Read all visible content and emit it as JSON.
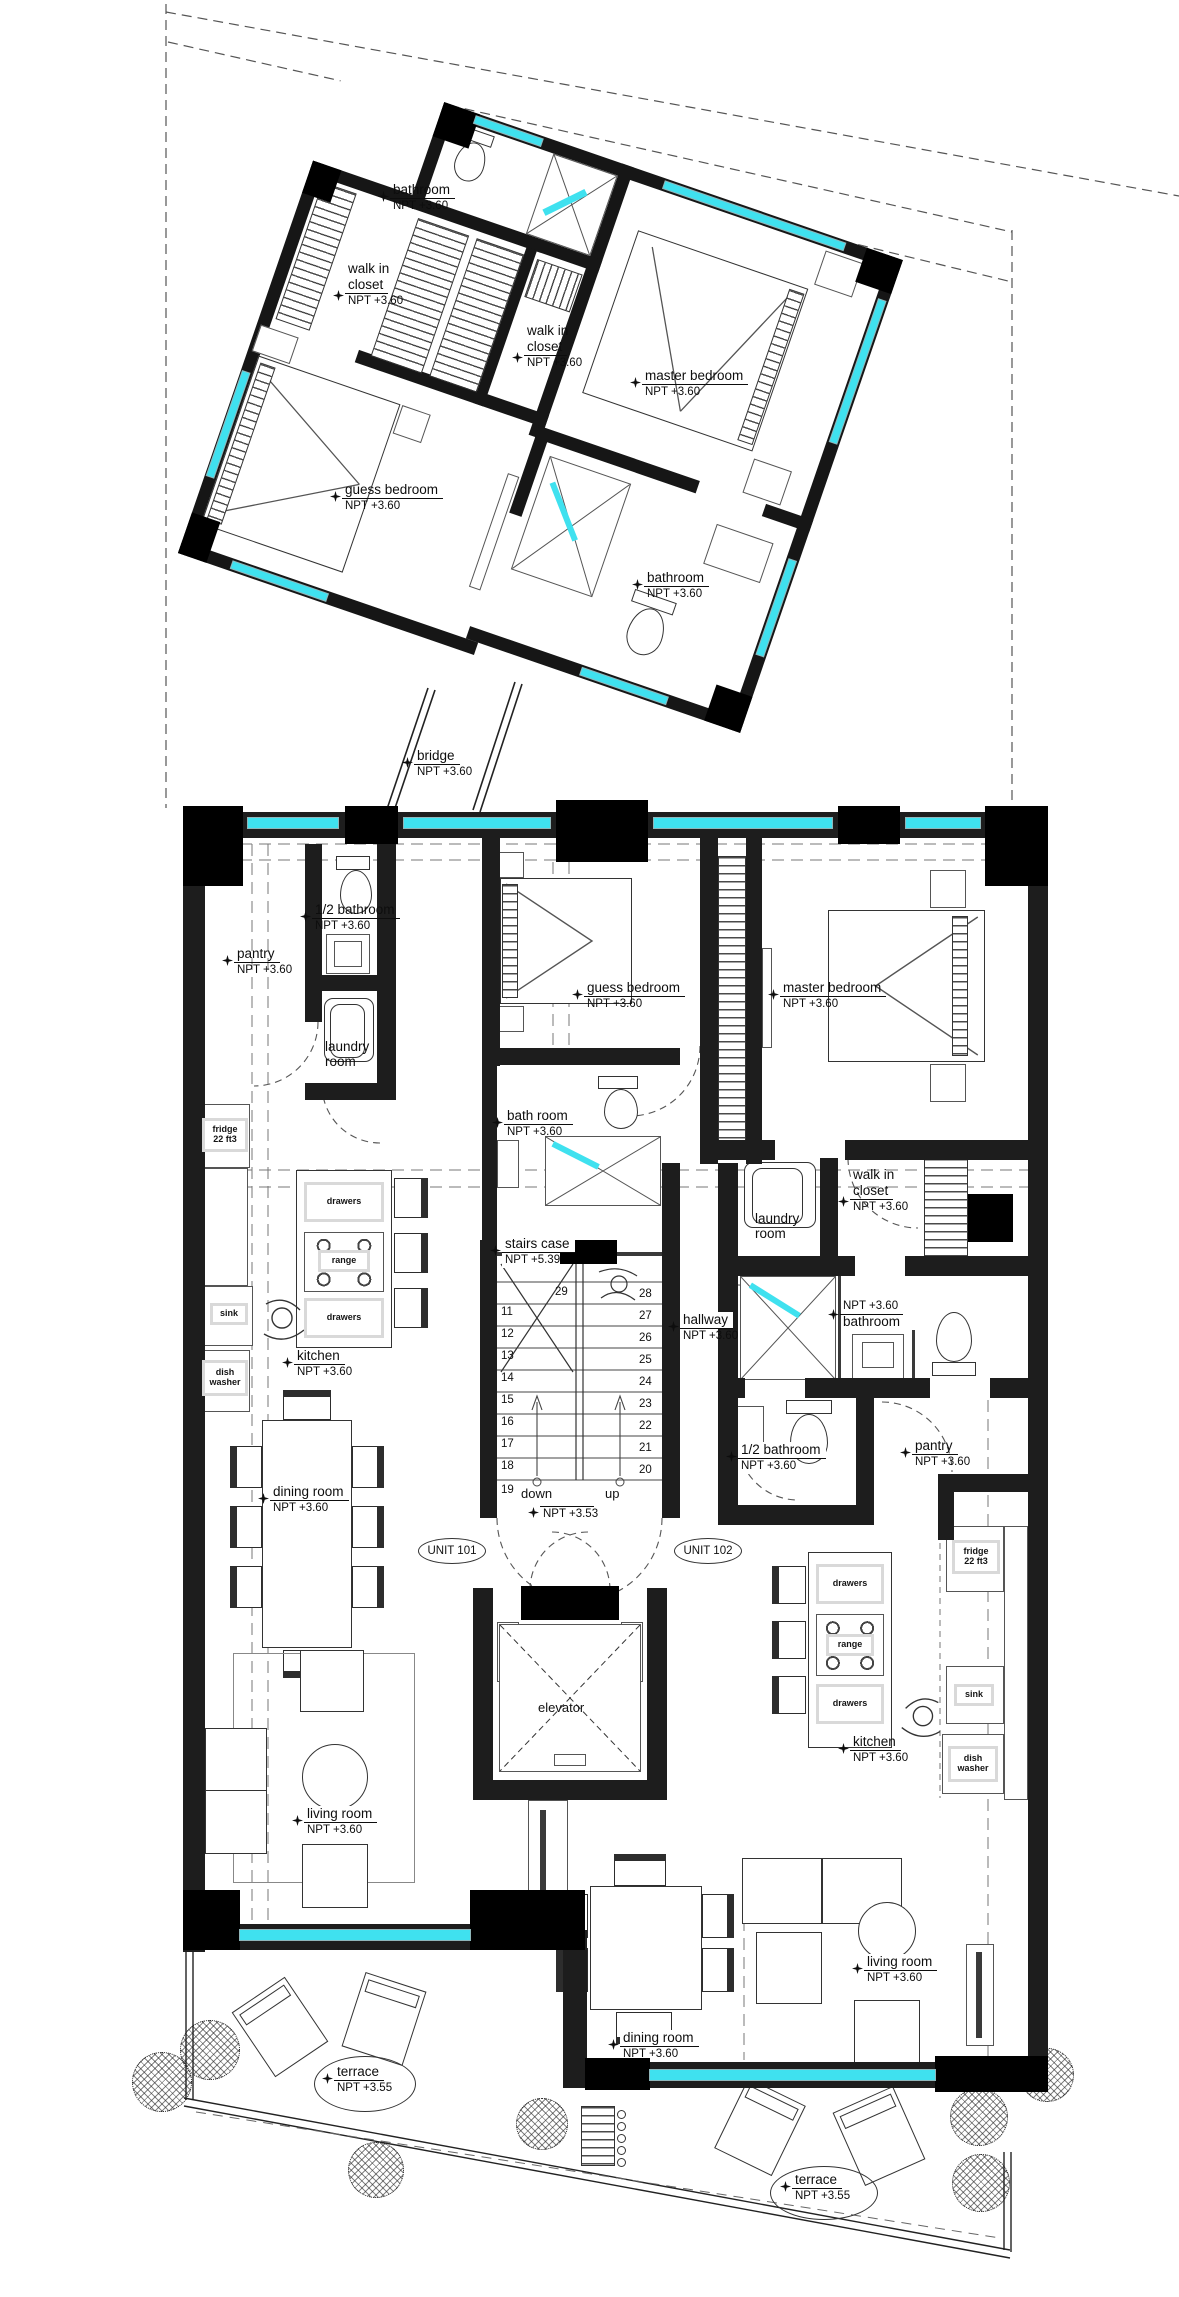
{
  "rooms": {
    "bathroom_top": {
      "name": "bathroom",
      "npt": "NPT +3.60"
    },
    "walkin_top_left": {
      "l1": "walk in",
      "name": "closet",
      "npt": "NPT +3.60"
    },
    "walkin_top_mid": {
      "l1": "walk in",
      "name": "closet",
      "npt": "NPT +3.60"
    },
    "master_top": {
      "name": "master bedroom",
      "npt": "NPT +3.60"
    },
    "guess_top": {
      "name": "guess bedroom",
      "npt": "NPT +3.60"
    },
    "bathroom_top2": {
      "name": "bathroom",
      "npt": "NPT +3.60"
    },
    "bridge": {
      "name": "bridge",
      "npt": "NPT +3.60"
    },
    "half_bath_left": {
      "name": "1/2 bathroom",
      "npt": "NPT +3.60"
    },
    "pantry_left": {
      "name": "pantry",
      "npt": "NPT +3.60"
    },
    "laundry_left": {
      "l1": "laundry",
      "l2": "room"
    },
    "guess_bottom": {
      "name": "guess bedroom",
      "npt": "NPT +3.60"
    },
    "master_bottom": {
      "name": "master bedroom",
      "npt": "NPT +3.60"
    },
    "bath_room": {
      "name": "bath room",
      "npt": "NPT +3.60"
    },
    "walkin_right": {
      "l1": "walk in",
      "name": "closet",
      "npt": "NPT +3.60"
    },
    "laundry_right": {
      "l1": "laundry",
      "l2": "room"
    },
    "bathroom_right": {
      "name": "bathroom",
      "npt": "NPT +3.60"
    },
    "stairs_case": {
      "name": "stairs case",
      "npt": "NPT +5.39"
    },
    "hallway": {
      "name": "hallway",
      "npt": "NPT +3.60"
    },
    "kitchen_left": {
      "name": "kitchen",
      "npt": "NPT +3.60"
    },
    "dining_left": {
      "name": "dining room",
      "npt": "NPT +3.60"
    },
    "half_bath_right": {
      "name": "1/2 bathroom",
      "npt": "NPT +3.60"
    },
    "pantry_right": {
      "name": "pantry",
      "npt": "NPT +3.60"
    },
    "kitchen_right": {
      "name": "kitchen",
      "npt": "NPT +3.60"
    },
    "living_left": {
      "name": "living room",
      "npt": "NPT +3.60"
    },
    "dining_bottom": {
      "name": "dining room",
      "npt": "NPT +3.60"
    },
    "living_right": {
      "name": "living room",
      "npt": "NPT +3.60"
    },
    "terrace_left": {
      "name": "terrace",
      "npt": "NPT +3.55"
    },
    "terrace_right": {
      "name": "terrace",
      "npt": "NPT +3.55"
    },
    "elevator": {
      "name": "elevator"
    }
  },
  "units": {
    "u101": "UNIT 101",
    "u102": "UNIT 102"
  },
  "stairs": {
    "top": "29",
    "left": [
      "11",
      "12",
      "13",
      "14",
      "15",
      "16",
      "17",
      "18",
      "19"
    ],
    "right": [
      "28",
      "27",
      "26",
      "25",
      "24",
      "23",
      "22",
      "21",
      "20"
    ],
    "down": "down",
    "up": "up",
    "npt_landing": "NPT +3.53"
  },
  "appliances": {
    "fridge1": "fridge",
    "fridge2": "22  ft3",
    "drawers": "drawers",
    "range": "range",
    "sink": "sink",
    "dish1": "dish",
    "dish2": "washer"
  },
  "colors": {
    "wall": "#1d1d1d",
    "window": "#3fe1ef",
    "block": "#000000"
  }
}
